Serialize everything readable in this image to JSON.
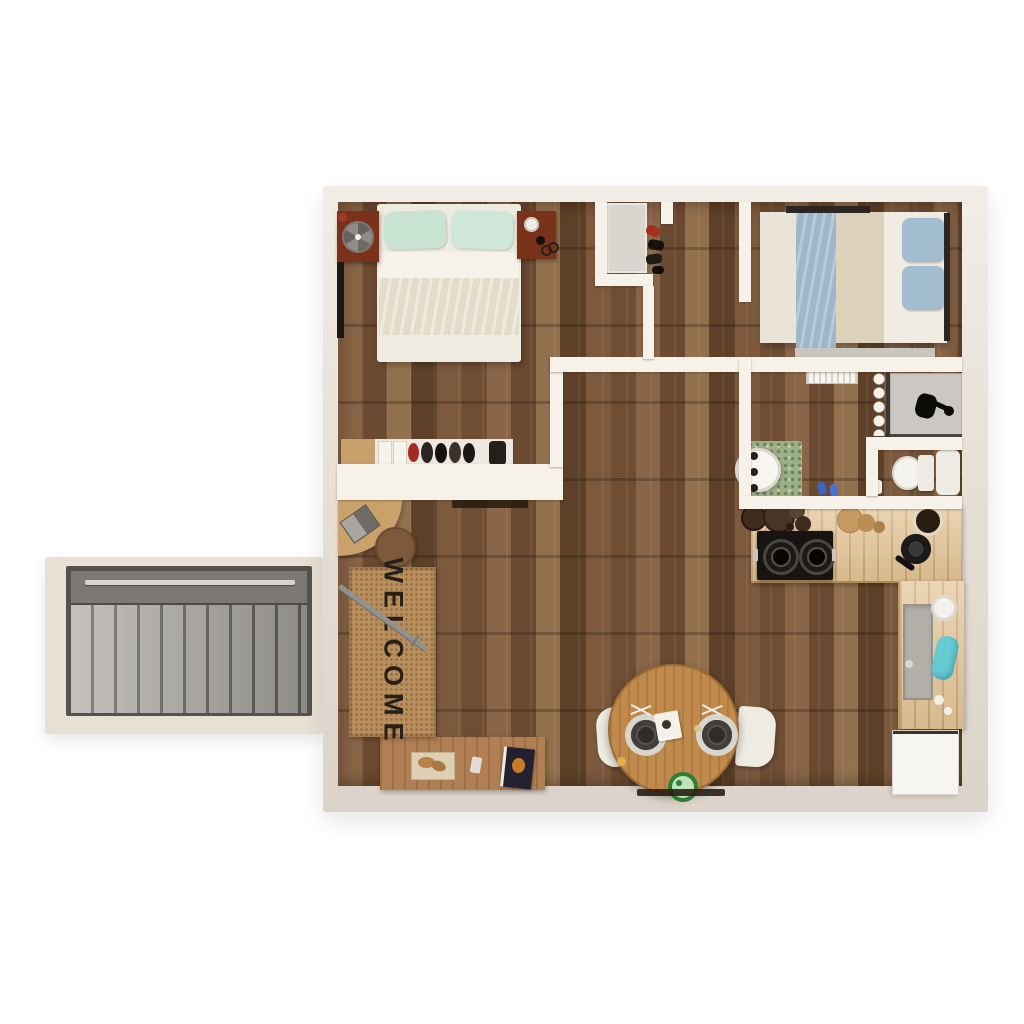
{
  "welcome_mat": {
    "text": "WELCOME"
  },
  "colors": {
    "wall_outer": "#ece3d9",
    "wall_inner": "#f6f1e9",
    "floor_base": "#7a573b",
    "porch": "#e9e0d5",
    "stairs_step": "#b5b2ac",
    "stairs_frame": "#55524d",
    "stairs_rail": "#7c7975",
    "mat_tan": "#b98f5e",
    "mat_text": "#262018",
    "nightstand": "#7b321b",
    "pillow_mint": "#c9e3d3",
    "bed1_blanket": "#e4dcc9",
    "bed2_throw": "#9db6c9",
    "pillow_blue": "#a3bed1",
    "counter_wood": "#e2c394",
    "cooktop_black": "#181412",
    "table_wood": "#bf8a4b",
    "chair_white": "#eeebe3",
    "rug_green": "#9cb086",
    "cyan_item": "#66ccd4",
    "slipper_blue": "#3b66c9",
    "bowl_green": "#2f7d33",
    "shower_floor": "#cbc8c3",
    "fridge_white": "#f7f5f1"
  }
}
